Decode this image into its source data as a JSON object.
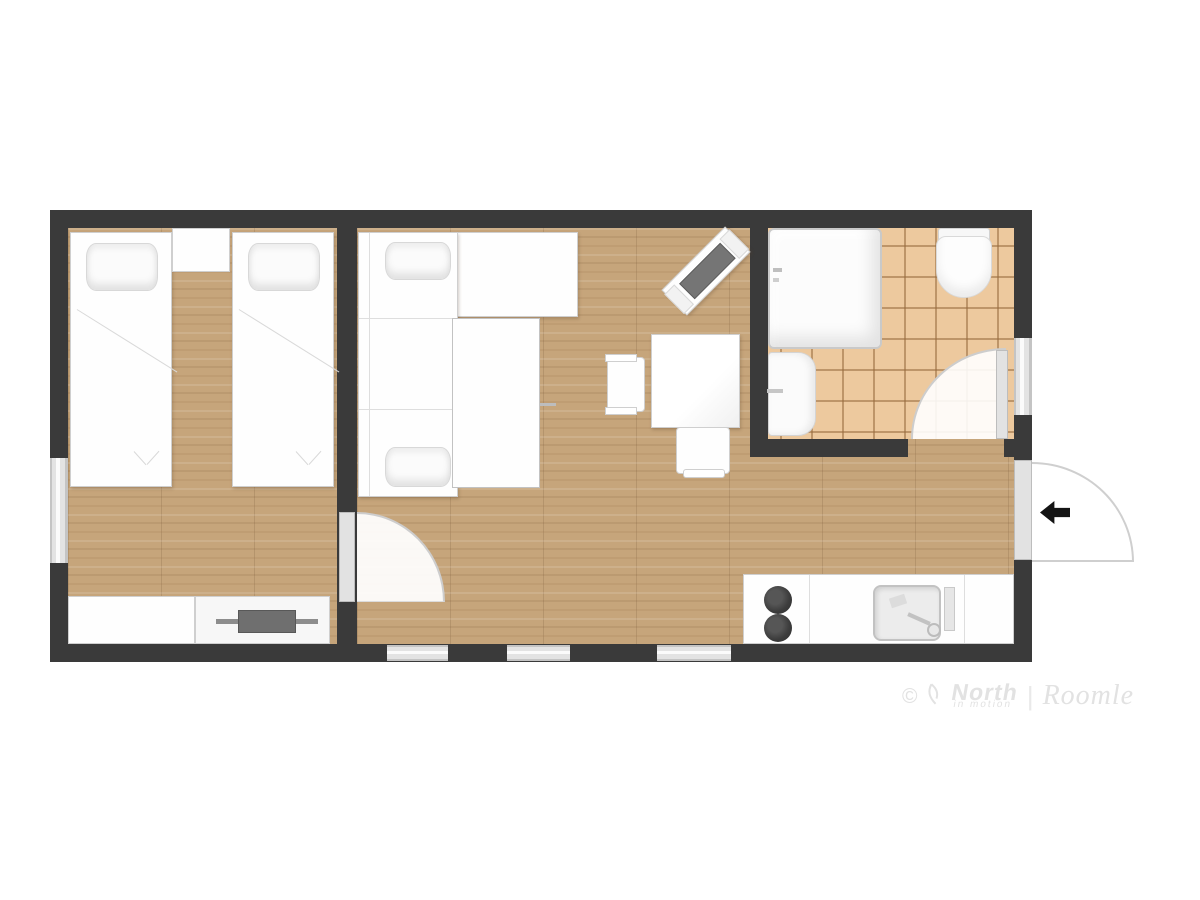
{
  "watermark": {
    "copyright": "©",
    "brand": "North",
    "brand_sub": "in motion",
    "separator": "|",
    "logo": "Roomle"
  },
  "colors": {
    "wall": "#3a3a3a",
    "wood_floor": "#c6a57b",
    "tile_floor": "#edc99e",
    "tile_grout": "#966a3e",
    "furniture": "#fefefe",
    "furniture_edge": "#cfcfcf",
    "window_glass": "#e3e3e3",
    "tv_screen": "#757575",
    "entry_arrow": "#141414",
    "watermark_text": "#e2e2e2"
  },
  "plan": {
    "type": "apartment-floor-plan",
    "rooms": [
      {
        "name": "bedroom",
        "floor": "wood",
        "furniture": [
          "twin-bed",
          "twin-bed",
          "nightstand",
          "dresser",
          "tv"
        ]
      },
      {
        "name": "living-room",
        "floor": "wood",
        "furniture": [
          "sofa-bed",
          "media-sideboard",
          "dining-table",
          "chair",
          "chair",
          "kitchenette-counter",
          "cooktop",
          "kitchen-sink"
        ]
      },
      {
        "name": "bathroom",
        "floor": "tile",
        "furniture": [
          "bathtub",
          "toilet",
          "washbasin"
        ]
      }
    ],
    "openings": [
      "bedroom-door",
      "bathroom-door",
      "entry-door",
      "window-bedroom-left",
      "window-living-bottom-1",
      "window-living-bottom-2",
      "window-living-bottom-3",
      "window-bathroom-right"
    ],
    "entry_direction": "left"
  }
}
